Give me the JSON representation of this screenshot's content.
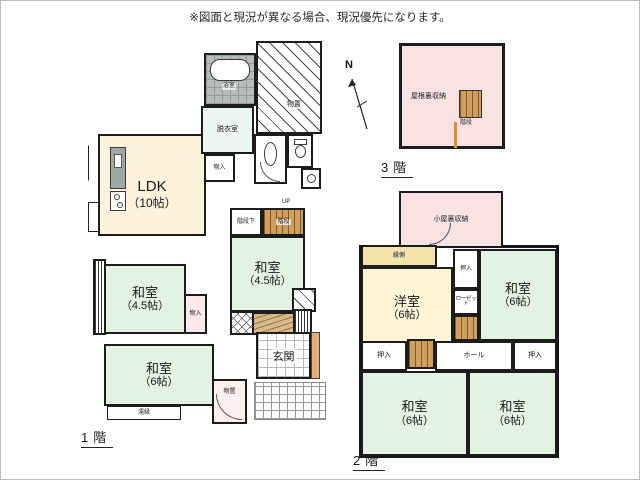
{
  "note": "※図面と現況が異なる場合、現況優先になります。",
  "compass": {
    "label": "N"
  },
  "floor1": {
    "label": "1階",
    "rooms": {
      "ldk": {
        "name": "LDK",
        "size": "（10帖）"
      },
      "washitsu_mid": {
        "name": "和室",
        "size": "（4.5帖）"
      },
      "washitsu_left": {
        "name": "和室",
        "size": "（4.5帖）"
      },
      "washitsu_bottom": {
        "name": "和室",
        "size": "（6帖）"
      },
      "genkan": "玄関",
      "bath": "浴室",
      "datsuishitsu": "脱衣室",
      "monoire_top": "物入",
      "monoire_mid": "物入",
      "monooki_top": "物置",
      "monooki_bottom": "物置",
      "kaidan_shita": "階段下",
      "kaidan": "階段",
      "up": "UP",
      "nureen": "濡縁"
    }
  },
  "floor2": {
    "label": "2階",
    "rooms": {
      "koyaura": "小屋裏収納",
      "engawa": "縁側",
      "yoshitsu": {
        "name": "洋室",
        "size": "（6帖）"
      },
      "washitsu_tr": {
        "name": "和室",
        "size": "（6帖）"
      },
      "washitsu_bl": {
        "name": "和室",
        "size": "（6帖）"
      },
      "washitsu_br": {
        "name": "和室",
        "size": "（6帖）"
      },
      "oshiire_top": "押入",
      "closet": "ローゼット",
      "oshiire_left": "押入",
      "oshiire_right": "押入",
      "hall": "ホール",
      "up": "UP"
    }
  },
  "floor3": {
    "label": "3階",
    "rooms": {
      "yaneura": "屋根裏収納",
      "kaidan": "階段"
    }
  },
  "colors": {
    "washitsu_green": "#e3f2e3",
    "ldk_cream": "#fdf2da",
    "attic_pink": "#f8e2e2",
    "yoshitsu_yellow": "#fcf5d8",
    "engawa_yellow": "#f0e3ac",
    "stairs_wood": "#cf9f5f",
    "accent_orange": "#e0b078",
    "bath_gray": "#b4bdbb"
  }
}
